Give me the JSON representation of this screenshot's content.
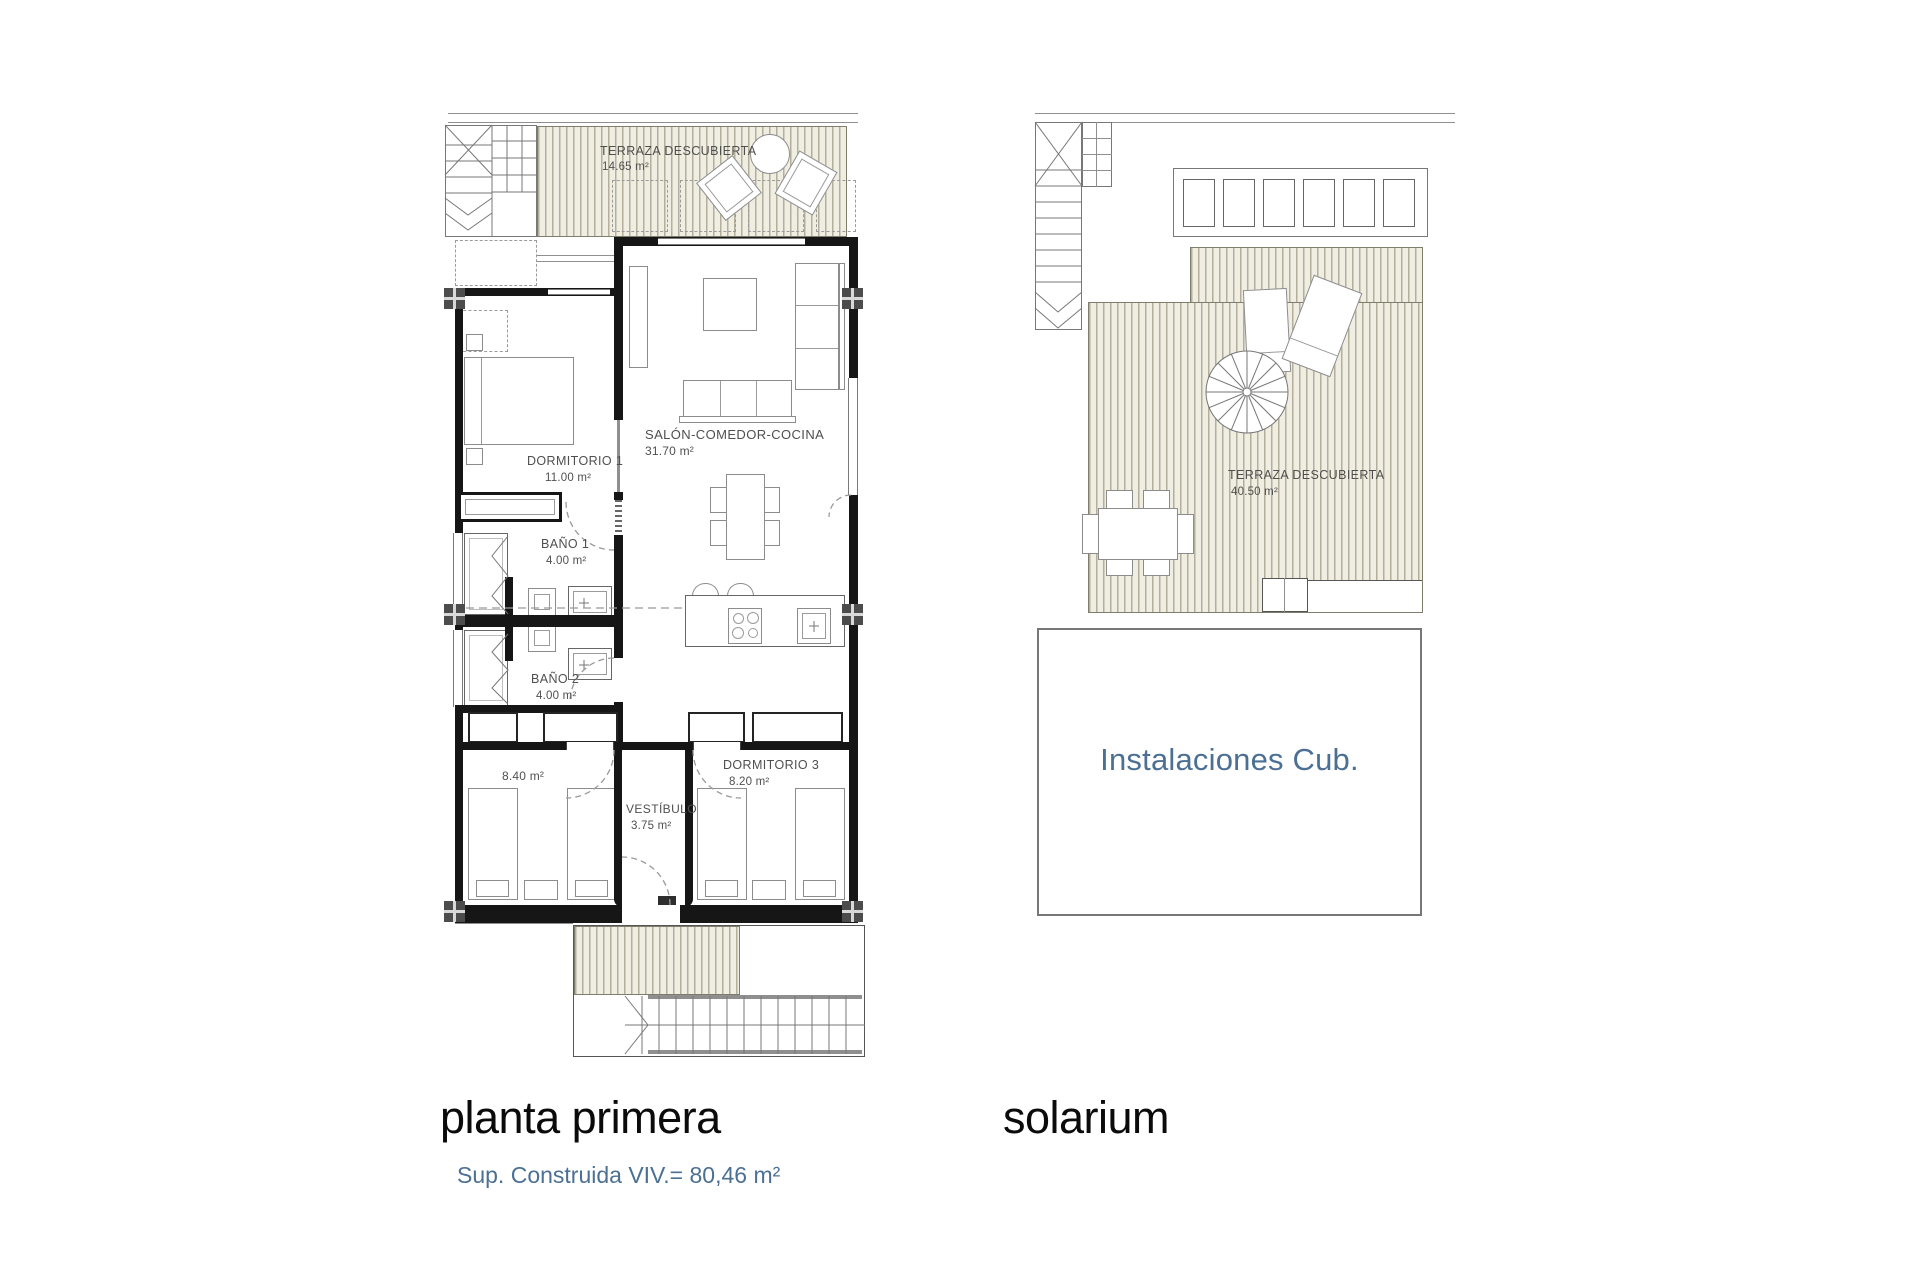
{
  "colors": {
    "accent_blue": "#4c7094",
    "wall": "#161616",
    "hatch_bg": "#f0eee2",
    "hatch_line": "#b3af9b"
  },
  "first_floor": {
    "title": "planta primera",
    "subtitle": "Sup. Construida VIV.= 80,46 m²",
    "terrace": {
      "name": "TERRAZA DESCUBIERTA",
      "area": "14.65 m²"
    },
    "salon": {
      "name": "SALÓN-COMEDOR-COCINA",
      "area": "31.70 m²"
    },
    "dormitorio1": {
      "name": "DORMITORIO 1",
      "area": "11.00 m²"
    },
    "banio1": {
      "name": "BAÑO 1",
      "area": "4.00 m²"
    },
    "banio2": {
      "name": "BAÑO 2",
      "area": "4.00 m²"
    },
    "dormitorio2": {
      "area": "8.40 m²"
    },
    "dormitorio3": {
      "name": "DORMITORIO 3",
      "area": "8.20 m²"
    },
    "vestibulo": {
      "name": "VESTÍBULO",
      "area": "3.75 m²"
    }
  },
  "solarium": {
    "title": "solarium",
    "terrace": {
      "name": "TERRAZA DESCUBIERTA",
      "area": "40.50 m²"
    },
    "instalaciones": {
      "name": "Instalaciones Cub."
    }
  }
}
